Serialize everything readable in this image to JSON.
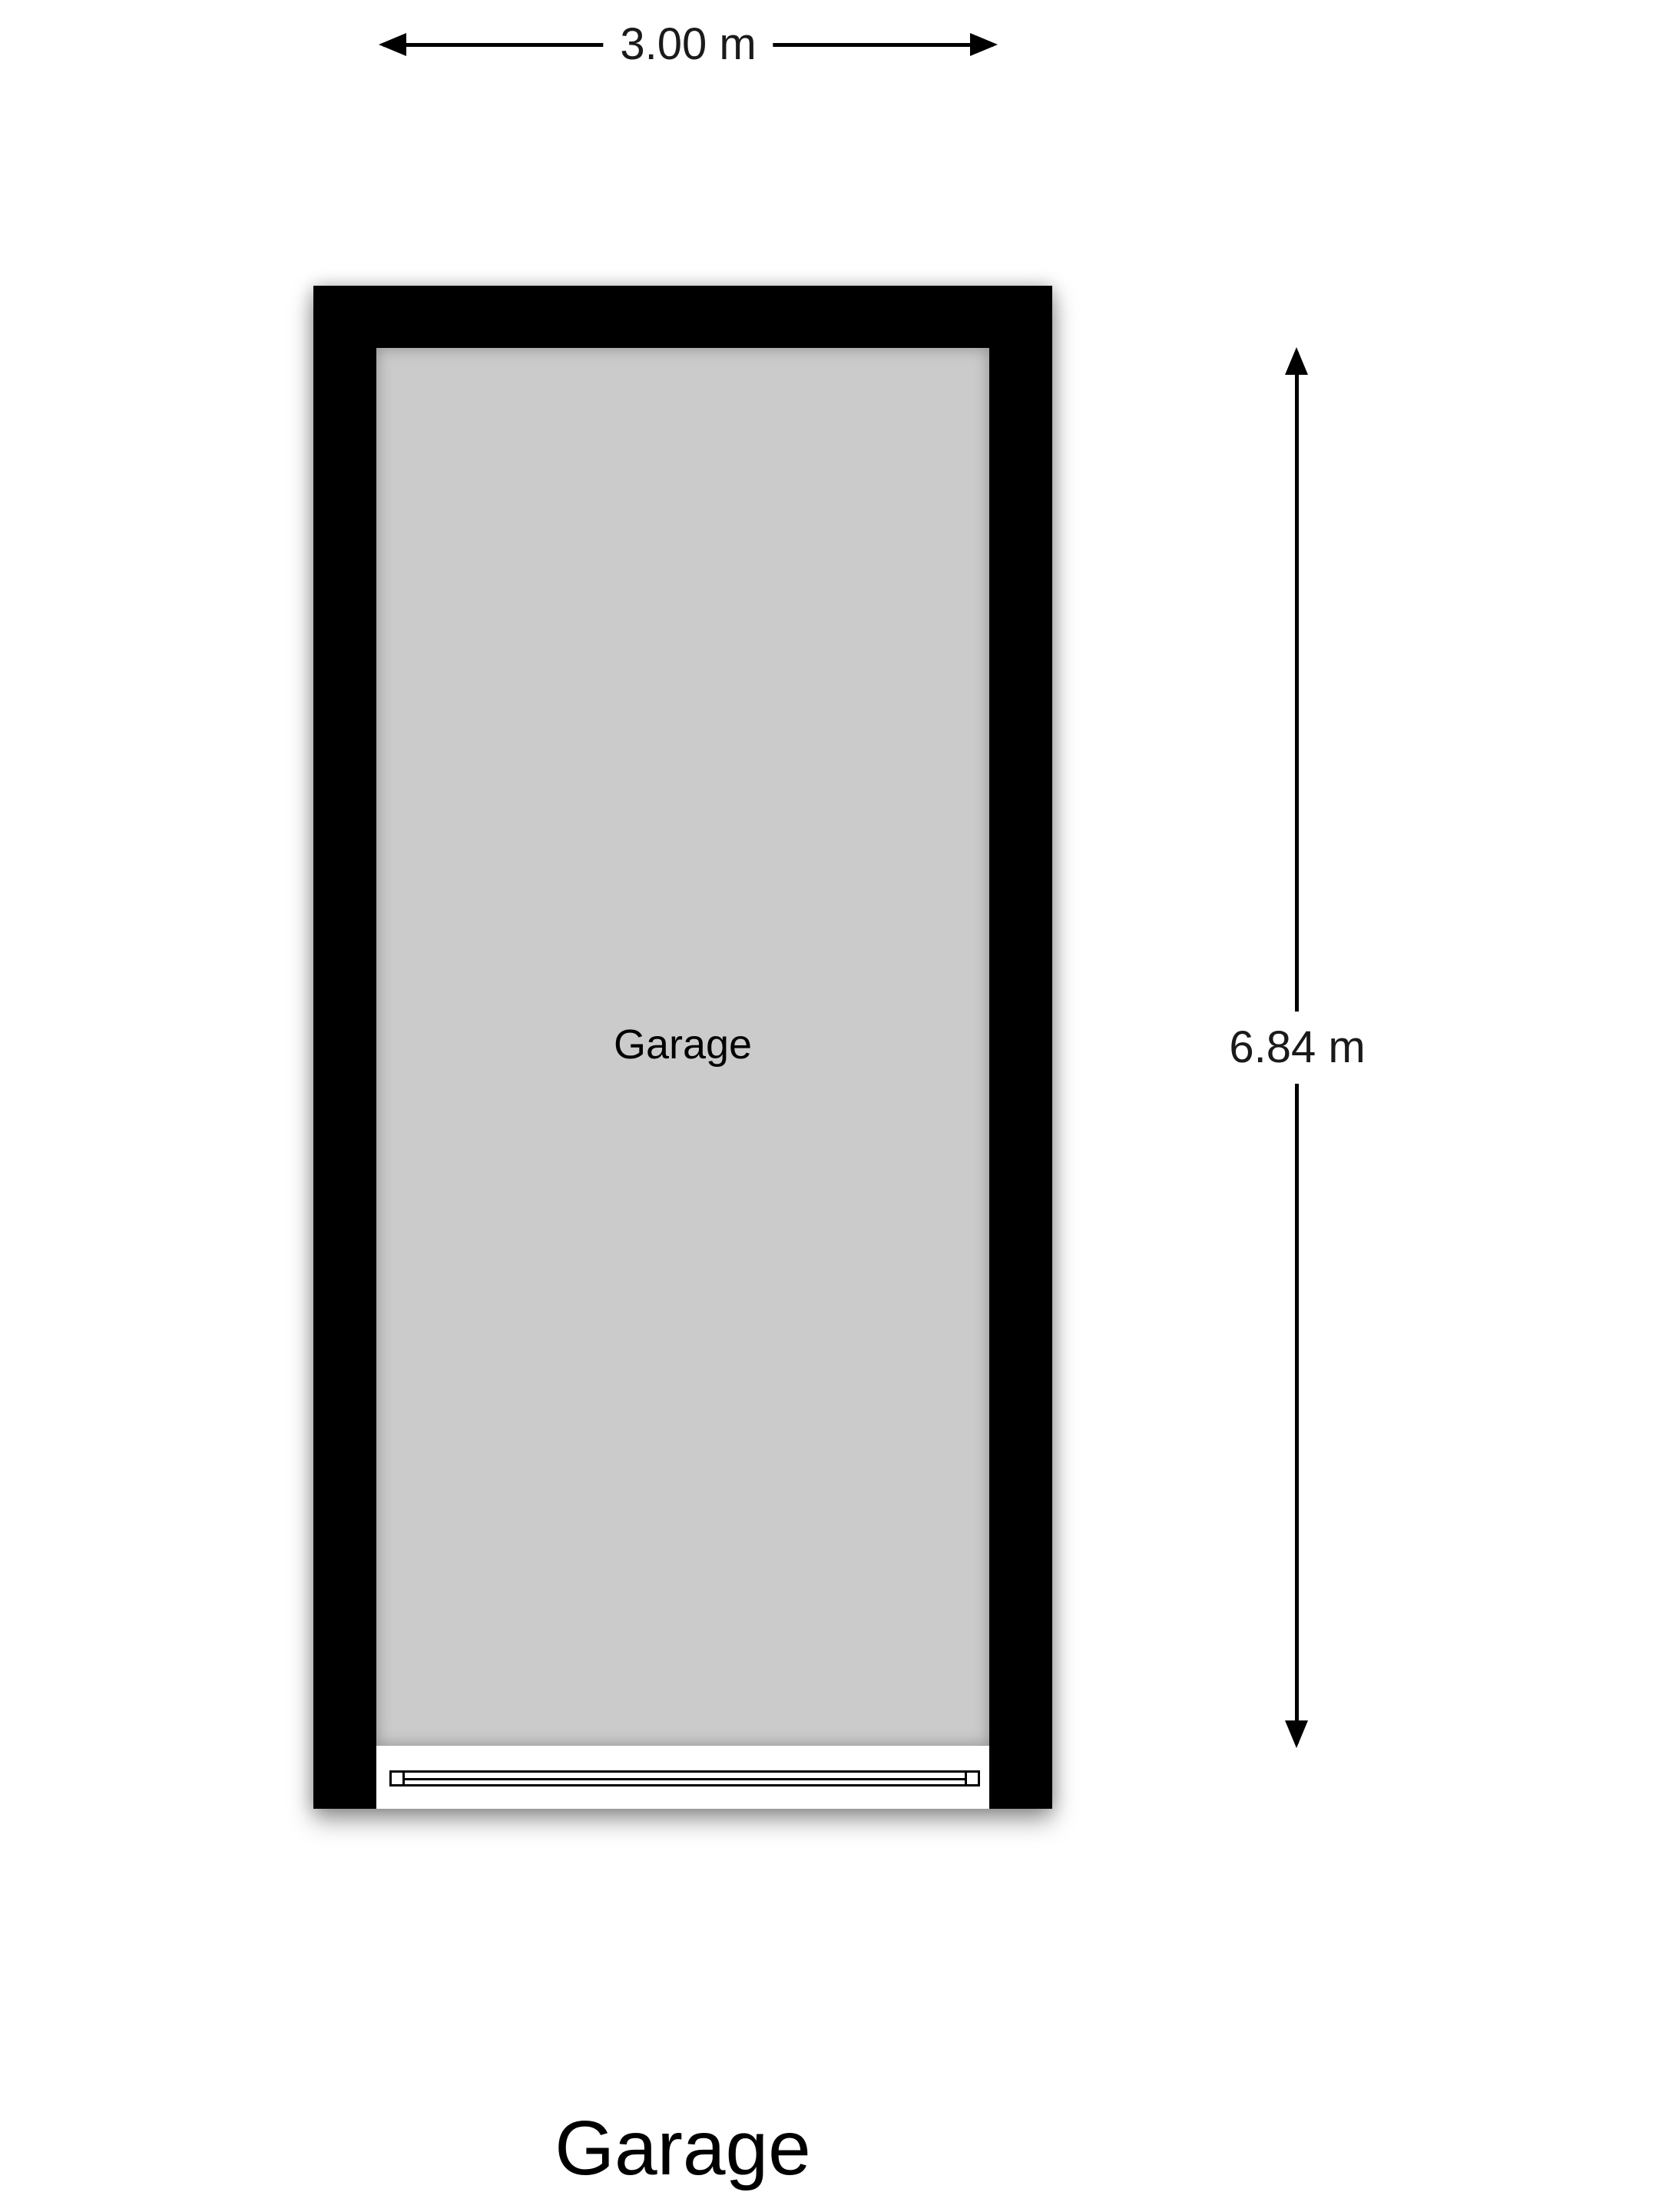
{
  "plan": {
    "title": "Garage",
    "room": {
      "label": "Garage"
    },
    "dimensions": {
      "width": {
        "label": "3.00 m"
      },
      "height": {
        "label": "6.84 m"
      }
    }
  },
  "colors": {
    "wall": "#000000",
    "floor": "#cbcbcb",
    "background": "#ffffff"
  }
}
